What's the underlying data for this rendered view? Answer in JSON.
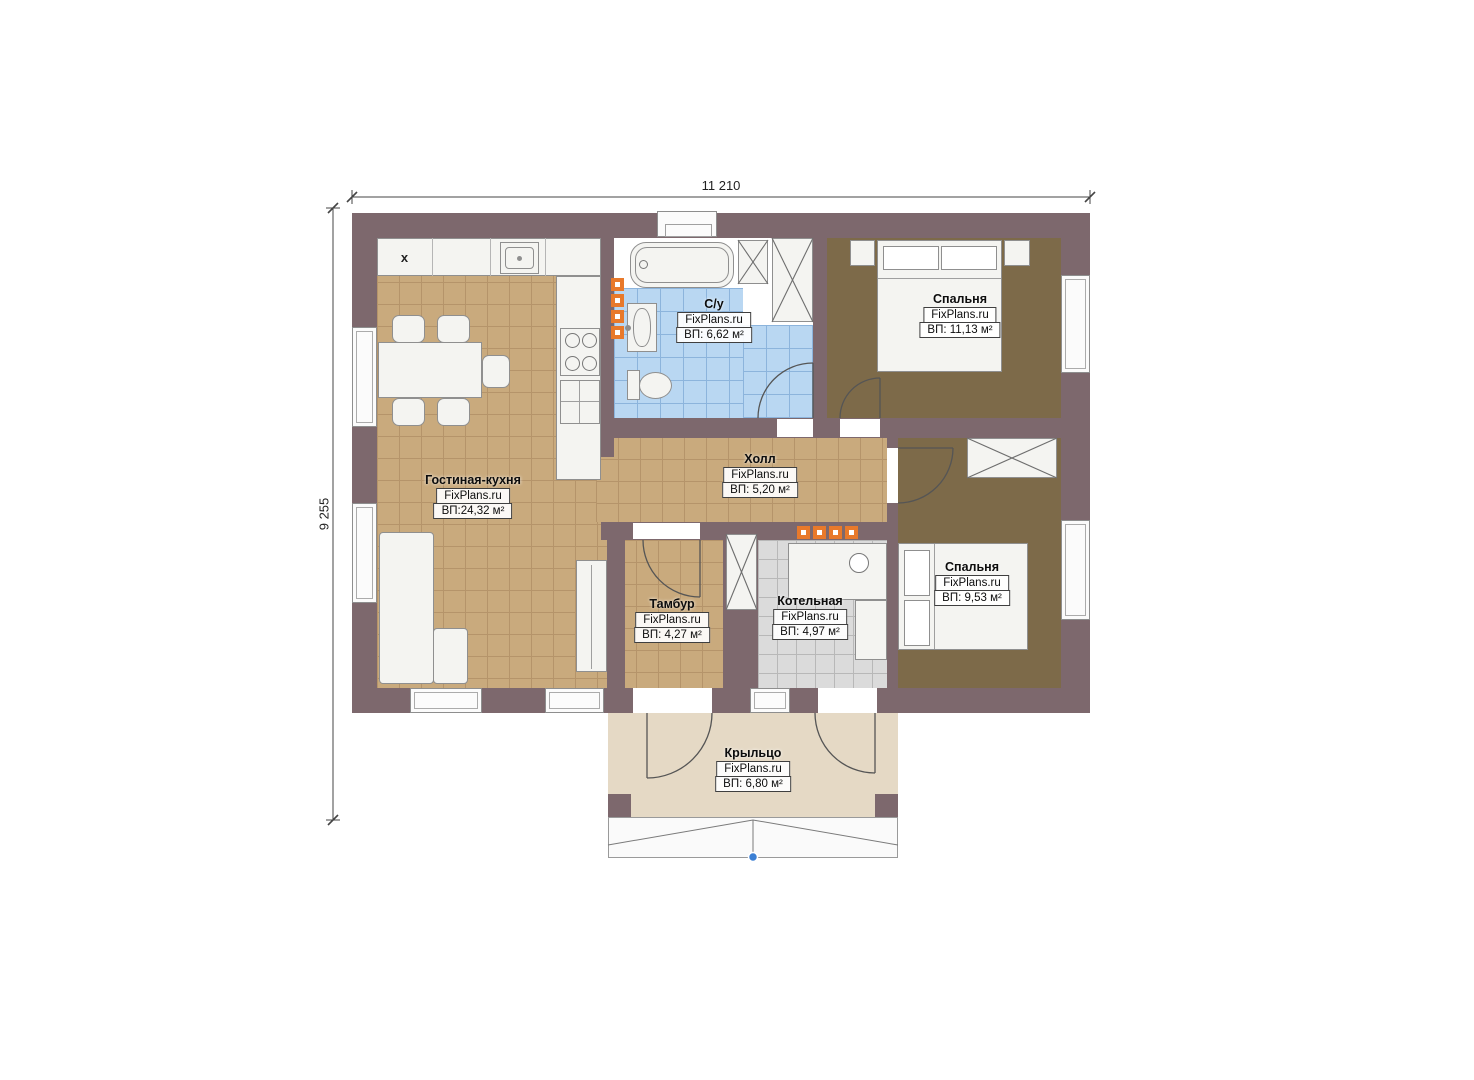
{
  "plan": {
    "dimensions": {
      "top_label": "11 210",
      "left_label": "9 255"
    },
    "rooms": [
      {
        "name": "Гостиная-кухня",
        "brand": "FixPlans.ru",
        "area": "ВП:24,32 м²"
      },
      {
        "name": "С/у",
        "brand": "FixPlans.ru",
        "area": "ВП: 6,62 м²"
      },
      {
        "name": "Спальня",
        "brand": "FixPlans.ru",
        "area": "ВП: 11,13 м²"
      },
      {
        "name": "Холл",
        "brand": "FixPlans.ru",
        "area": "ВП: 5,20 м²"
      },
      {
        "name": "Тамбур",
        "brand": "FixPlans.ru",
        "area": "ВП: 4,27 м²"
      },
      {
        "name": "Котельная",
        "brand": "FixPlans.ru",
        "area": "ВП: 4,97 м²"
      },
      {
        "name": "Спальня",
        "brand": "FixPlans.ru",
        "area": "ВП: 9,53 м²"
      },
      {
        "name": "Крыльцо",
        "brand": "FixPlans.ru",
        "area": "ВП: 6,80 м²"
      }
    ],
    "markers": {
      "kitchen_corner": "x"
    }
  },
  "colors": {
    "wall": "#7d686d",
    "floor_tan": "#c9aa7d",
    "floor_tan_line": "#b5946a",
    "floor_blue": "#b9d7f2",
    "floor_blue_line": "#8cb4dc",
    "floor_gray": "#dbdbdb",
    "floor_gray_line": "#b8b8b8",
    "floor_brown": "#7d6a49",
    "porch": "#e5d9c5",
    "furniture": "#f4f4f1",
    "furniture_border": "#8f8f8f",
    "radiator": "#e8792b",
    "accent_blue": "#3b7fd4",
    "line": "#555555"
  }
}
